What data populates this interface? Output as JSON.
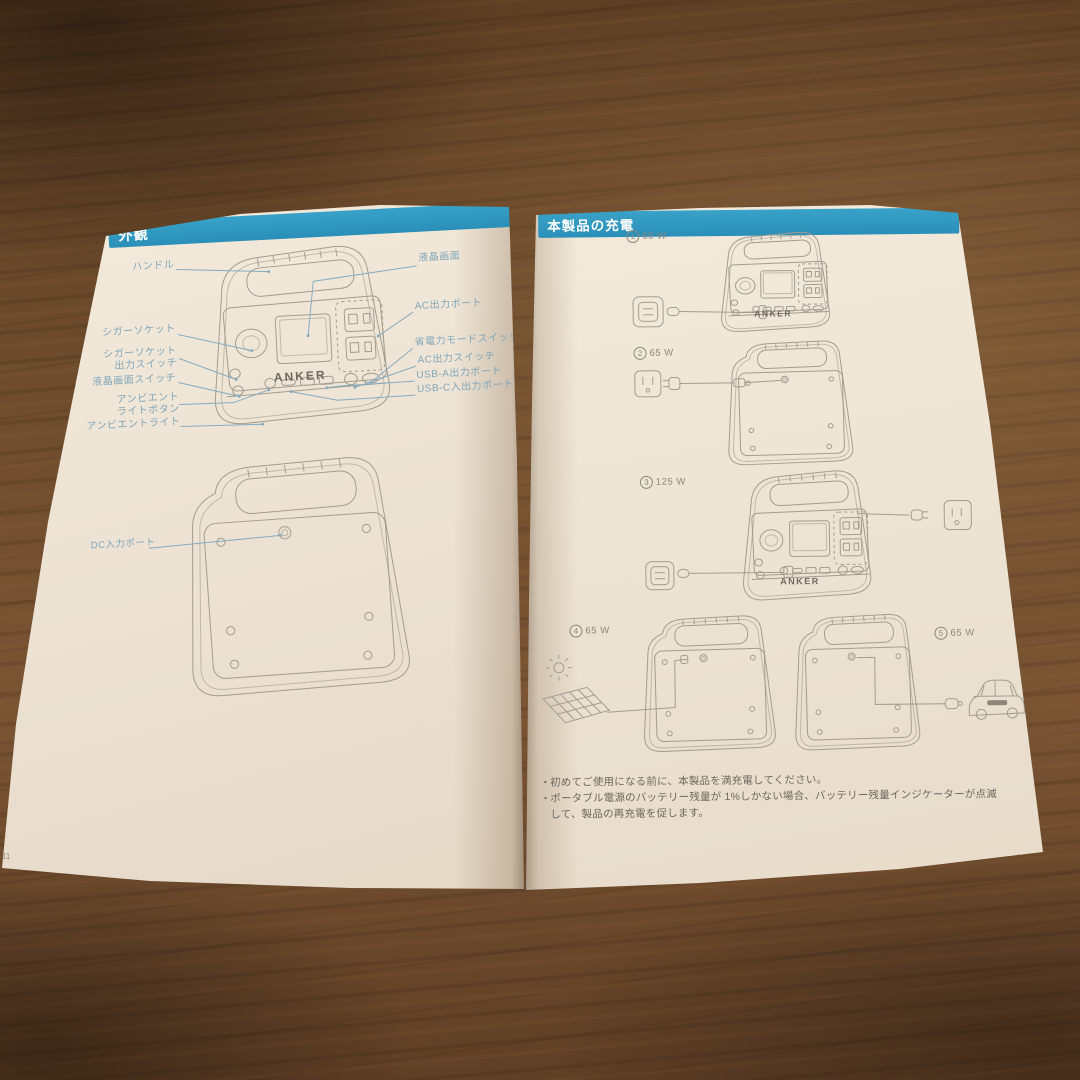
{
  "booklet": {
    "left_page": {
      "title": "外観",
      "page_number": "11",
      "brand": "ANKER",
      "labels": {
        "handle": "ハンドル",
        "lcd": "液晶画面",
        "ac_output_port": "AC出力ポート",
        "cigar_socket": "シガーソケット",
        "power_saving_mode_switch": "省電力モードスイッチ",
        "cigar_socket_output_switch": "シガーソケット\n出力スイッチ",
        "ac_output_switch": "AC出力スイッチ",
        "lcd_switch": "液晶画面スイッチ",
        "usb_a_output_port": "USB-A出力ポート",
        "usb_c_io_port": "USB-C入出力ポート",
        "ambient_light_button": "アンビエント\nライトボタン",
        "ambient_light": "アンビエントライト",
        "dc_input_port": "DC入力ポート"
      }
    },
    "right_page": {
      "title": "本製品の充電",
      "page_number": "12",
      "brand": "ANKER",
      "bullet_char": "・",
      "methods": [
        {
          "num": "1",
          "watt": "60 W"
        },
        {
          "num": "2",
          "watt": "65 W"
        },
        {
          "num": "3",
          "watt": "125 W"
        },
        {
          "num": "4",
          "watt": "65 W"
        },
        {
          "num": "5",
          "watt": "65 W"
        }
      ],
      "notes": [
        "初めてご使用になる前に、本製品を満充電してください。",
        "ポータブル電源のバッテリー残量が 1%しかない場合、バッテリー残量インジケーターが点滅して、製品の再充電を促します。"
      ]
    },
    "colors": {
      "banner_blue": "#2f98c0",
      "label_teal": "#7fa6bb",
      "page_cream": "#efe6d7",
      "wood_brown": "#6b4a2c"
    }
  }
}
